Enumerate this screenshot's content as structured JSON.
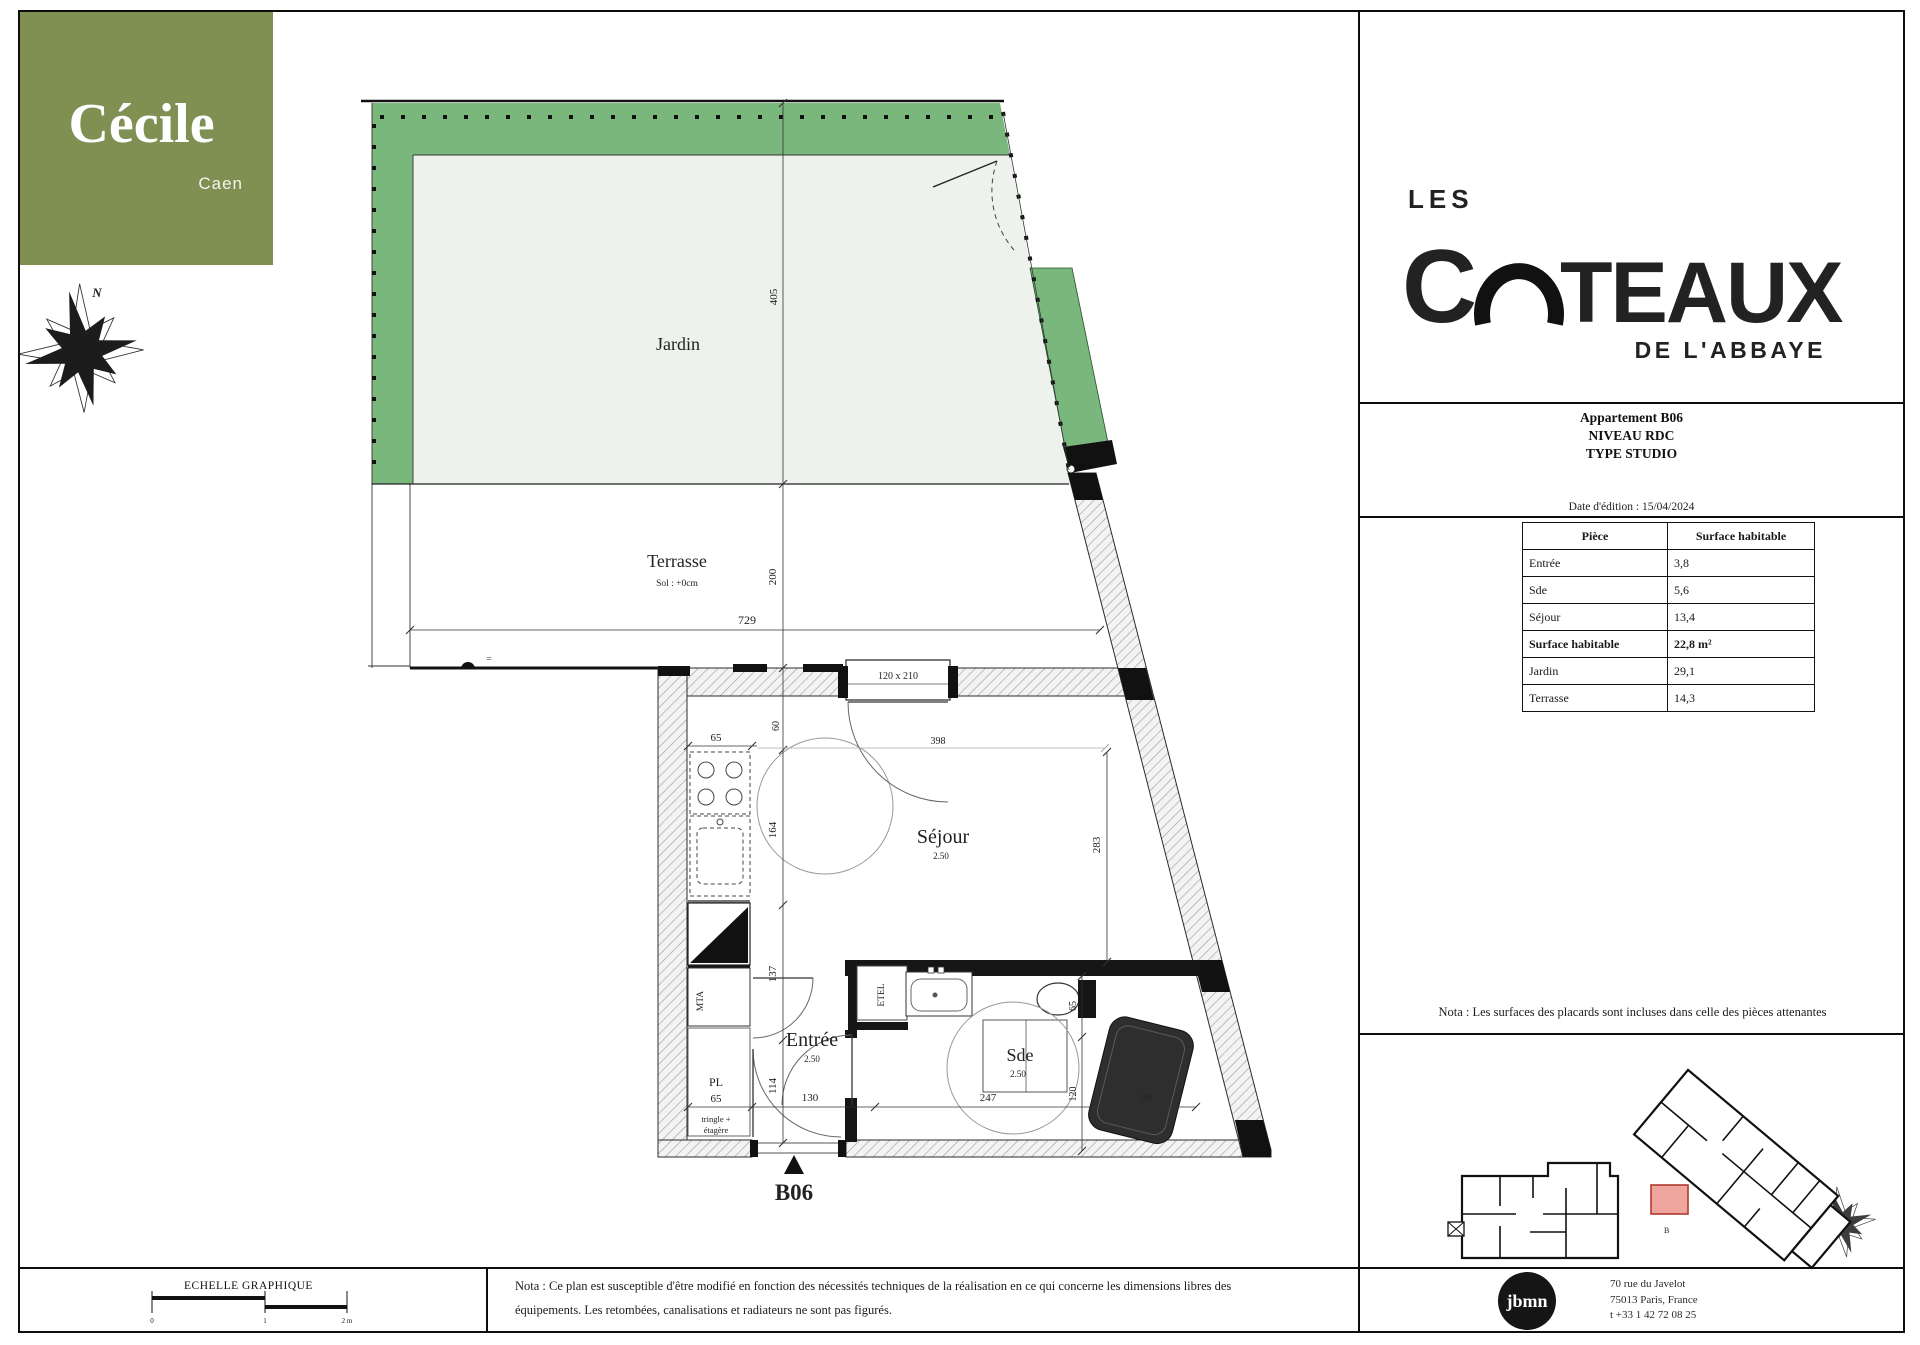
{
  "branding": {
    "cecile_name": "Cécile",
    "cecile_city": "Caen",
    "coteaux_les": "LES",
    "coteaux_c": "C",
    "coteaux_teaux": "TEAUX",
    "coteaux_sub": "DE L'ABBAYE",
    "north_label": "N"
  },
  "colors": {
    "olive": "#808f52",
    "fence_green": "#7ab77c",
    "garden_light": "#edf3ec",
    "unit_red": "#eea59e",
    "b06_navy": "#1e3a66"
  },
  "info_panel": {
    "title1": "Appartement B06",
    "title2": "NIVEAU RDC",
    "title3": "TYPE STUDIO",
    "edition_date": "Date d'édition : 15/04/2024",
    "table": {
      "col_piece": "Pièce",
      "col_surface": "Surface habitable",
      "rows": [
        {
          "piece": "Entrée",
          "value": "3,8"
        },
        {
          "piece": "Sde",
          "value": "5,6"
        },
        {
          "piece": "Séjour",
          "value": "13,4"
        },
        {
          "piece": "Surface habitable",
          "value": "22,8 m²"
        },
        {
          "piece": "Jardin",
          "value": "29,1"
        },
        {
          "piece": "Terrasse",
          "value": "14,3"
        }
      ]
    },
    "nota": "Nota : Les surfaces des placards sont incluses dans celle des pièces attenantes",
    "mini_plan_unit": "B"
  },
  "plan": {
    "rooms": {
      "jardin": "Jardin",
      "terrasse": "Terrasse",
      "terrasse_sub": "Sol : +0cm",
      "sejour": "Séjour",
      "sejour_h": "2.50",
      "entree": "Entrée",
      "entree_h": "2.50",
      "sde": "Sde",
      "sde_h": "2.50",
      "pl": "PL",
      "pl_note1": "tringle +",
      "pl_note2": "étagère",
      "mta": "MTA",
      "etel": "ETEL"
    },
    "dims": {
      "jardin_h": "405",
      "terrasse_h": "200",
      "terrasse_w": "729",
      "eq": "=",
      "window": "120 x 210",
      "k65": "65",
      "k60": "60",
      "k398": "398",
      "k164": "164",
      "s283": "283",
      "e137": "137",
      "e114": "114",
      "b65": "65",
      "b130": "130",
      "b247": "247",
      "b90": "90",
      "r65": "65",
      "r120": "120"
    },
    "unit_label": "B06"
  },
  "footer": {
    "scale_label": "ECHELLE GRAPHIQUE",
    "tick0": "0",
    "tick1": "1",
    "tick2": "2 m",
    "nota_line1": "Nota : Ce plan est susceptible d'être modifié en fonction des nécessités techniques de la réalisation en ce qui concerne les dimensions libres des",
    "nota_line2": "équipements. Les retombées, canalisations et radiateurs ne sont pas figurés."
  },
  "agency": {
    "name": "jbmn",
    "addr1": "70 rue du Javelot",
    "addr2": "75013 Paris, France",
    "addr3": "t +33 1 42 72 08 25"
  }
}
